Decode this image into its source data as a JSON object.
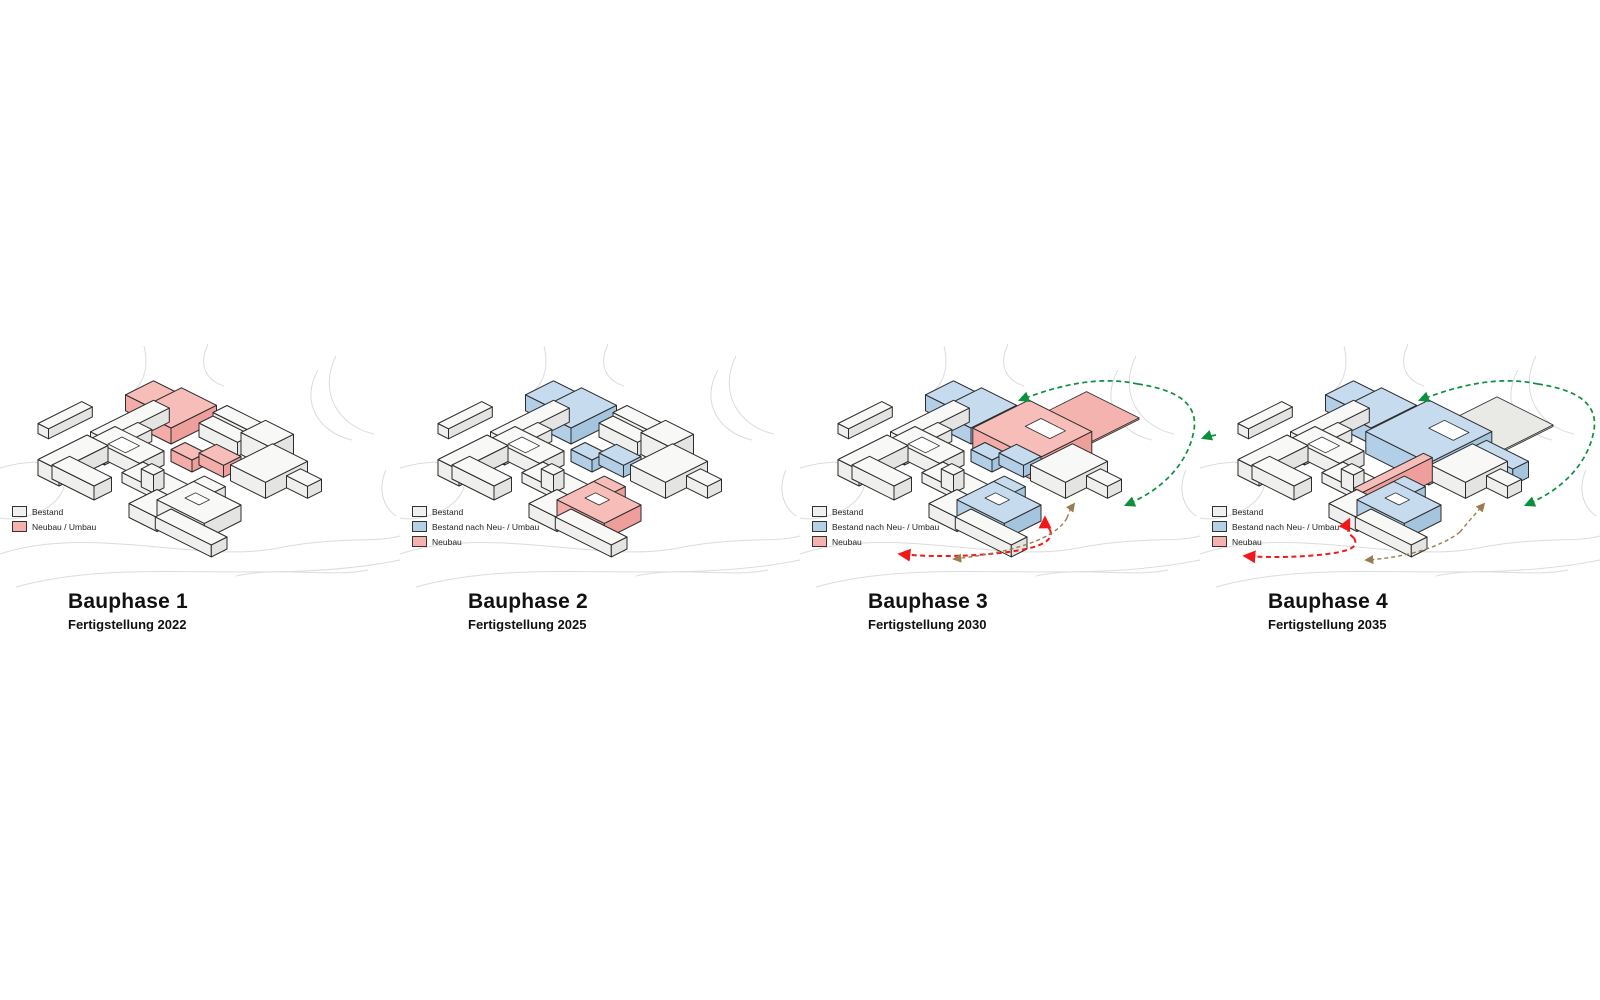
{
  "page": {
    "background": "#ffffff"
  },
  "colors": {
    "outline": "#2b2b2b",
    "street": "#dcdcdc",
    "court": "#ffffff",
    "bestand": {
      "top": "#f8f8f6",
      "left": "#efefed",
      "right": "#e4e4e2",
      "swatch": "#f0f0ee"
    },
    "umbau": {
      "top": "#f7bdb9",
      "left": "#f3aca8",
      "right": "#ee9f9b",
      "swatch": "#f4b1ae"
    },
    "blau": {
      "top": "#c6dbee",
      "left": "#b3cfe7",
      "right": "#a5c5df",
      "swatch": "#b5d1e8"
    },
    "pad_pink": "#f5b3af",
    "pad_gray": "#e9e9e6",
    "arrow_green": "#0b913e",
    "arrow_red": "#f01818",
    "arrow_brown": "#9b7c50"
  },
  "phases": [
    {
      "id": "p1",
      "title": "Bauphase 1",
      "subtitle": "Fertigstellung 2022",
      "legend": [
        {
          "type": "bestand",
          "label": "Bestand"
        },
        {
          "type": "umbau",
          "label": "Neubau / Umbau"
        }
      ],
      "highlights": {
        "T1": "umbau",
        "T2": "umbau",
        "M1": "umbau",
        "M2": "umbau"
      },
      "removed": [],
      "extras": [],
      "arrows": []
    },
    {
      "id": "p2",
      "title": "Bauphase 2",
      "subtitle": "Fertigstellung 2025",
      "legend": [
        {
          "type": "bestand",
          "label": "Bestand"
        },
        {
          "type": "blau",
          "label": "Bestand nach Neu- / Umbau"
        },
        {
          "type": "umbau",
          "label": "Neubau"
        }
      ],
      "highlights": {
        "T1": "blau",
        "T2": "blau",
        "M1": "blau",
        "M2": "blau",
        "Dwing": "umbau",
        "Dmain": "umbau"
      },
      "removed": [],
      "extras": [],
      "arrows": []
    },
    {
      "id": "p3",
      "title": "Bauphase 3",
      "subtitle": "Fertigstellung 2030",
      "legend": [
        {
          "type": "bestand",
          "label": "Bestand"
        },
        {
          "type": "blau",
          "label": "Bestand nach Neu- / Umbau"
        },
        {
          "type": "umbau",
          "label": "Neubau"
        }
      ],
      "highlights": {
        "T1": "blau",
        "T2": "blau",
        "M1": "blau",
        "M2": "blau",
        "Dwing": "blau",
        "Dmain": "blau"
      },
      "removed": [
        "R0",
        "R1",
        "R2"
      ],
      "extras": [
        "pad3",
        "N3"
      ],
      "arrows": [
        "green",
        "red3",
        "brown3"
      ]
    },
    {
      "id": "p4",
      "title": "Bauphase 4",
      "subtitle": "Fertigstellung 2035",
      "legend": [
        {
          "type": "bestand",
          "label": "Bestand"
        },
        {
          "type": "blau",
          "label": "Bestand nach Neu- / Umbau"
        },
        {
          "type": "umbau",
          "label": "Neubau"
        }
      ],
      "highlights": {
        "T1": "blau",
        "T2": "blau",
        "Dwing": "blau",
        "Dmain": "blau"
      },
      "removed": [
        "R0",
        "R1",
        "R2",
        "M1",
        "M2"
      ],
      "extras": [
        "pad4",
        "N4",
        "X4",
        "P4"
      ],
      "arrows": [
        "green",
        "greenLeft",
        "red4",
        "brown4"
      ]
    }
  ]
}
